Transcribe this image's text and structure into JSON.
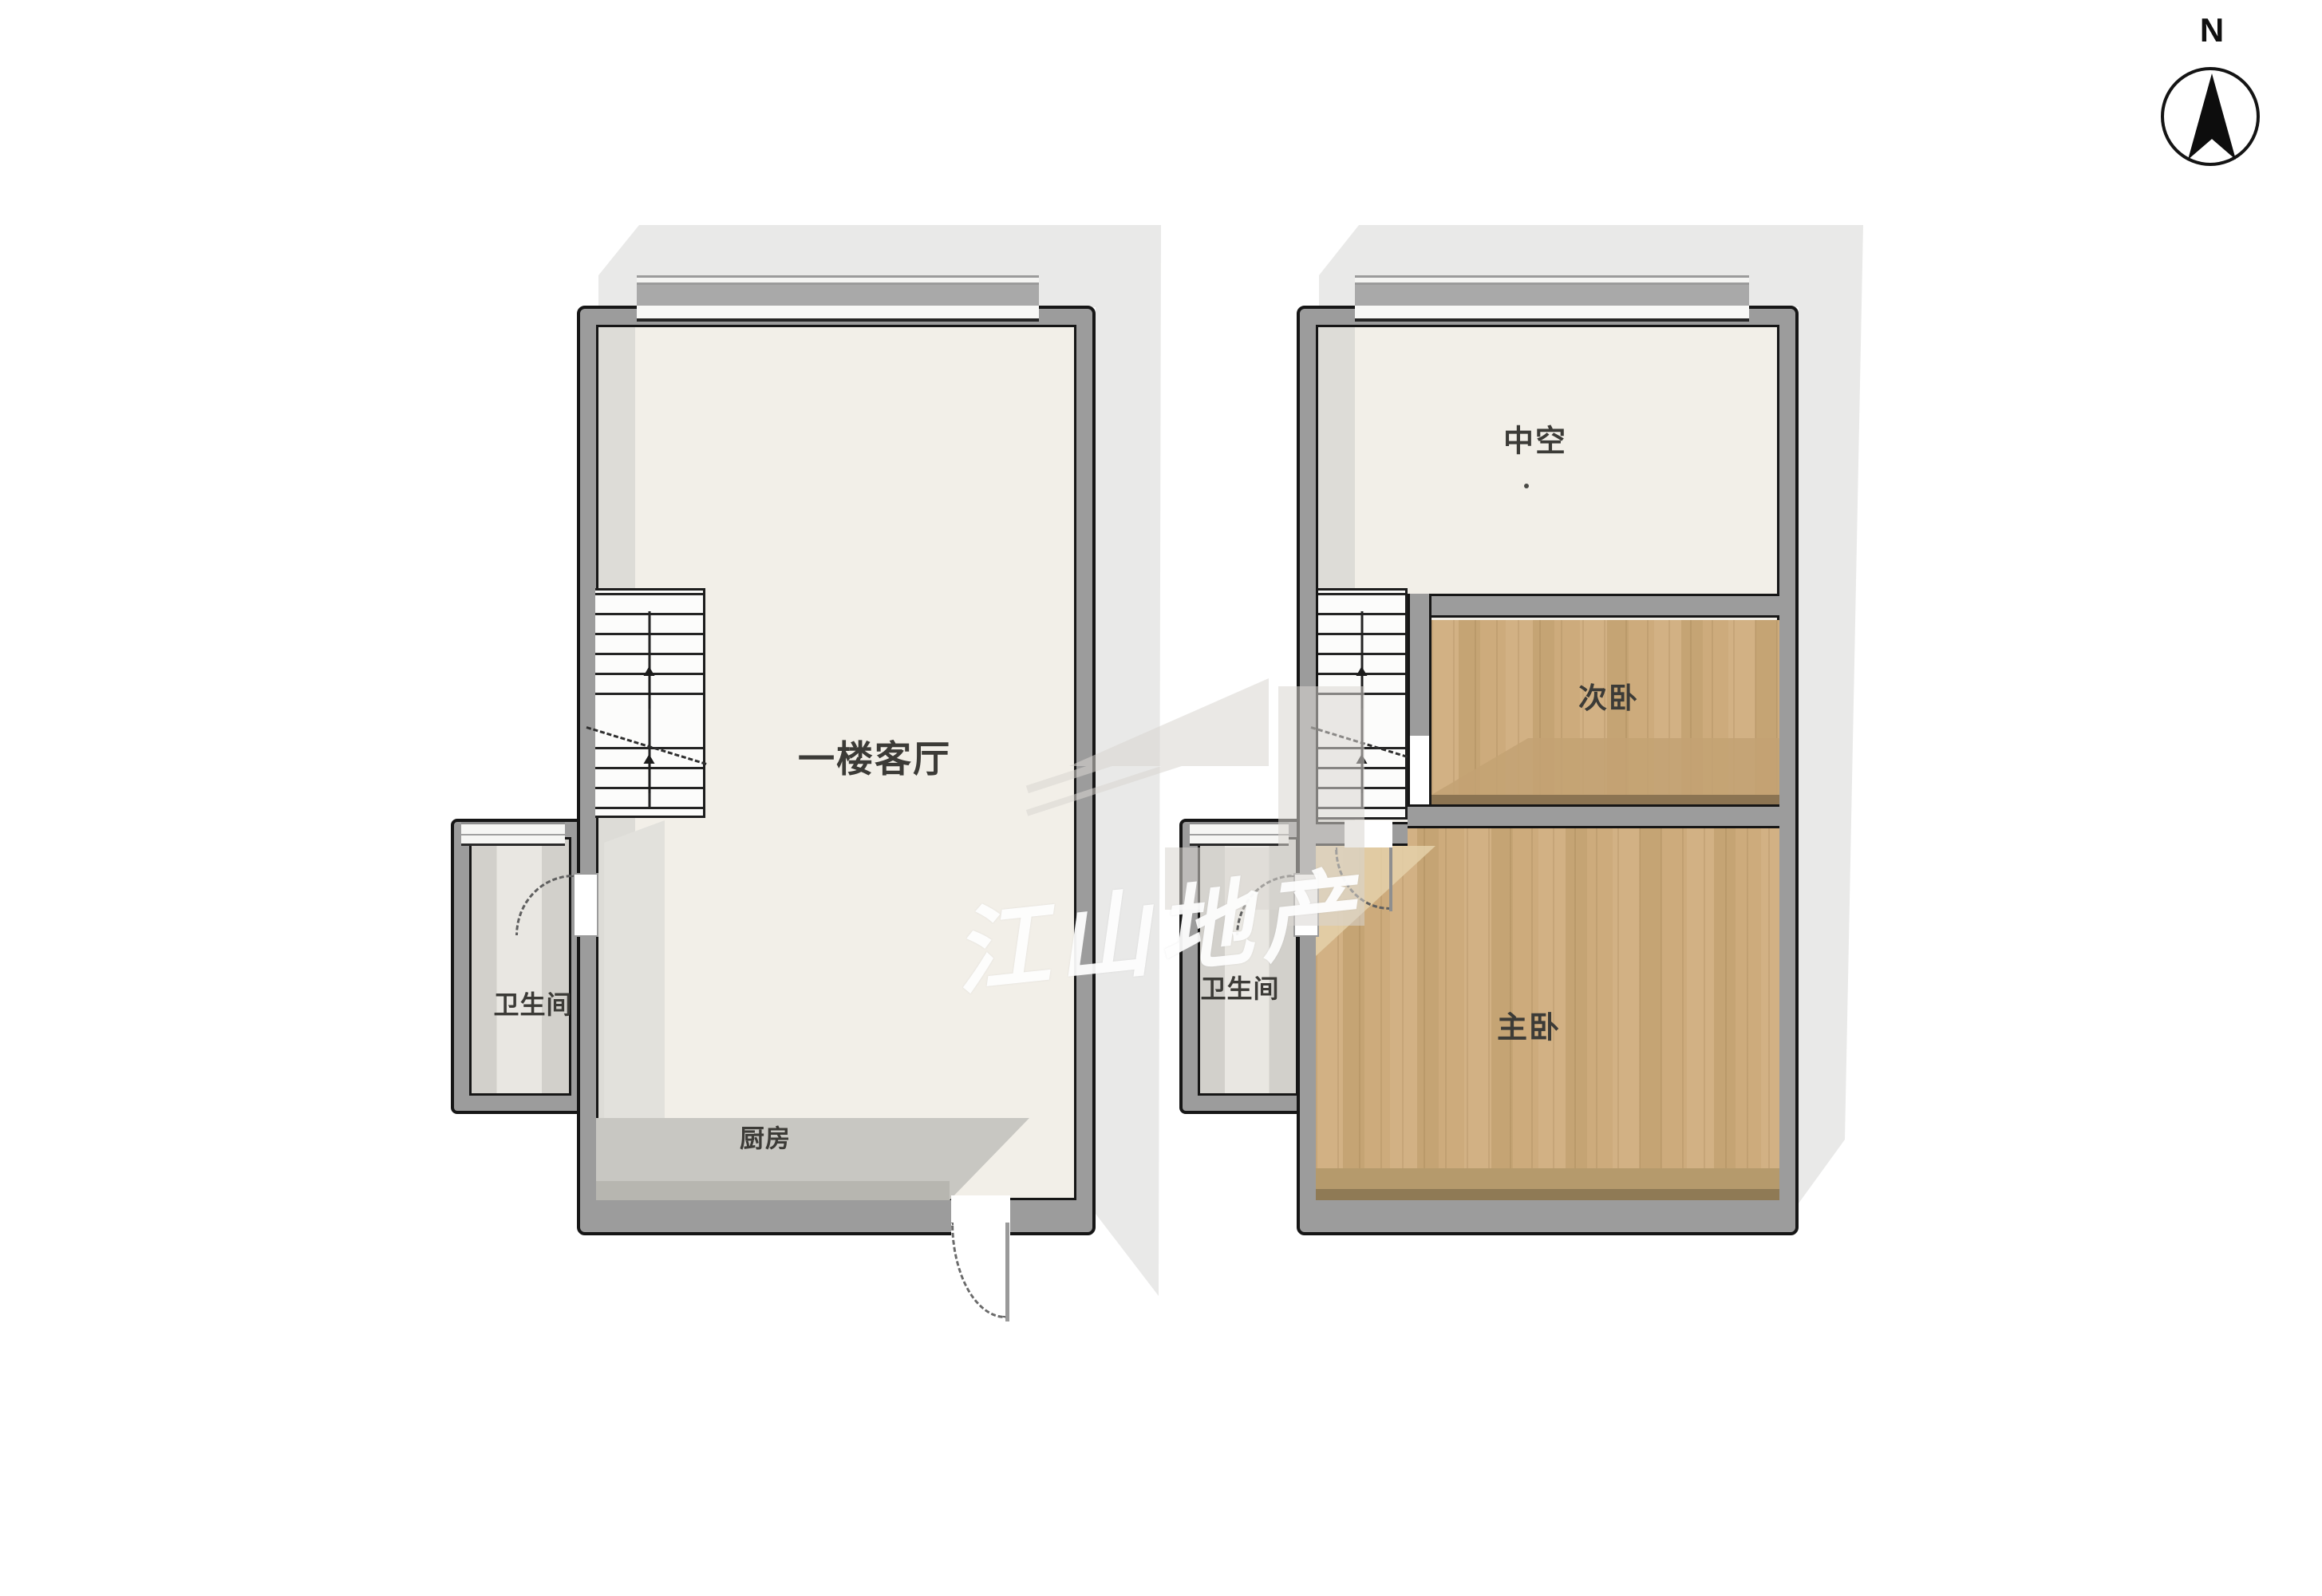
{
  "compass": {
    "label": "N"
  },
  "watermark": {
    "text": "江山地产"
  },
  "floor1": {
    "living_room": "一楼客厅",
    "bathroom": "卫生间",
    "kitchen": "厨房"
  },
  "floor2": {
    "void": "中空",
    "secondary_bedroom": "次卧",
    "master_bedroom": "主卧",
    "bathroom": "卫生间"
  },
  "colors": {
    "wall_fill": "#9c9c9c",
    "wall_outline": "#161616",
    "floor_cream": "#f2efe8",
    "wood_floor": "#cdab7c",
    "bath_floor": "#dcdad5",
    "kitchen_gray": "#c8c7c2",
    "shadow_gray": "#e9e9e8"
  }
}
